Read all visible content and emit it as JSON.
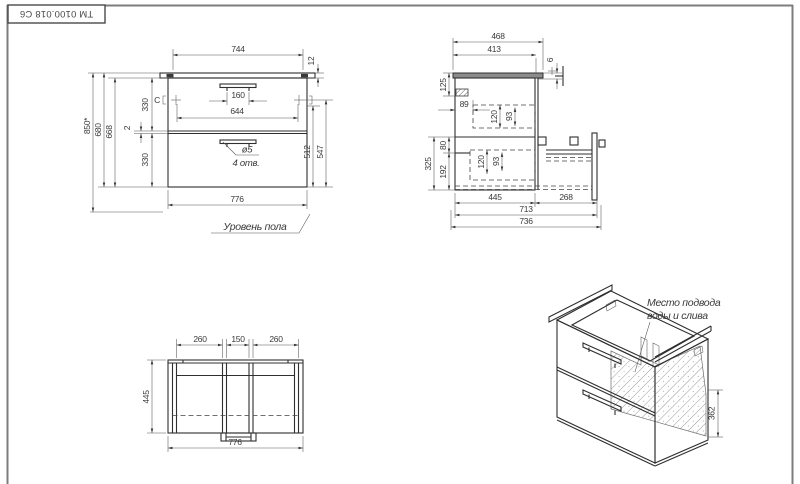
{
  "title_block": {
    "code": "ТМ 0100.018 С6"
  },
  "colors": {
    "line": "#2f2f2f",
    "thin_line": "#555555",
    "frame": "#7d7d7d",
    "text": "#3a3a3a",
    "background": "#ffffff"
  },
  "front_view": {
    "dims": {
      "d744": "744",
      "d12": "12",
      "d160": "160",
      "d644": "644",
      "d330_top": "330",
      "d2": "2",
      "d330_bottom": "330",
      "d668": "668",
      "d680": "680",
      "d850": "850*",
      "d512": "512",
      "d547": "547",
      "d776": "776"
    },
    "hole_dia": "ø5",
    "hole_count": "4 отв.",
    "floor_label": "Уровень пола",
    "mark_c": "C"
  },
  "side_view": {
    "dims": {
      "d468": "468",
      "d413": "413",
      "d6": "6",
      "d125": "125",
      "d89": "89",
      "d120_top": "120",
      "d93_top": "93",
      "d80": "80",
      "d325": "325",
      "d192": "192",
      "d120_bottom": "120",
      "d93_bottom": "93",
      "d445": "445",
      "d268": "268",
      "d713": "713",
      "d736": "736"
    }
  },
  "bottom_view": {
    "dims": {
      "d260_left": "260",
      "d150": "150",
      "d260_right": "260",
      "d445": "445",
      "d776": "776"
    }
  },
  "iso_view": {
    "note_line1": "Место подвода",
    "note_line2": "воды и слива",
    "d362": "362"
  },
  "bottom_caption": "Штриховкой показана зона подвода воды и слива"
}
